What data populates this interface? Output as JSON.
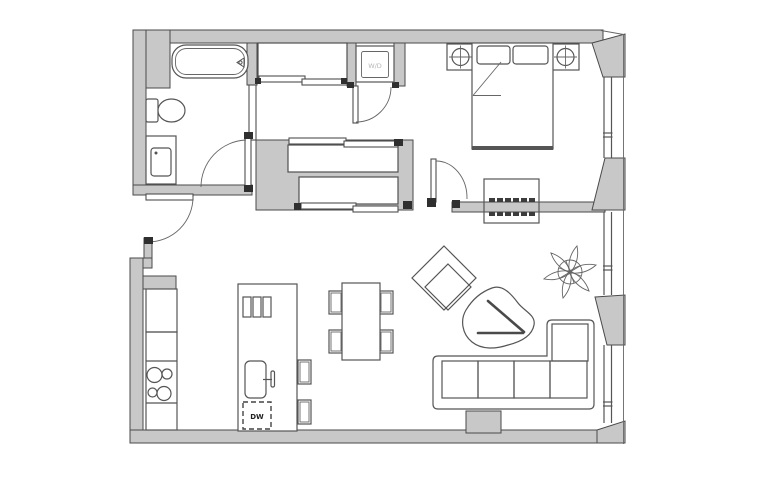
{
  "plan": {
    "labels": {
      "washer_dryer": "W/D",
      "dishwasher": "DW"
    },
    "colors": {
      "background": "#ffffff",
      "wall_fill": "#c8c8c8",
      "wall_outline": "#4a4a4a",
      "line": "#555555",
      "jamb_mark": "#2f2f2f",
      "washer_dryer_label": "#b5b5b5",
      "dishwasher_label": "#1f1f1f"
    }
  }
}
